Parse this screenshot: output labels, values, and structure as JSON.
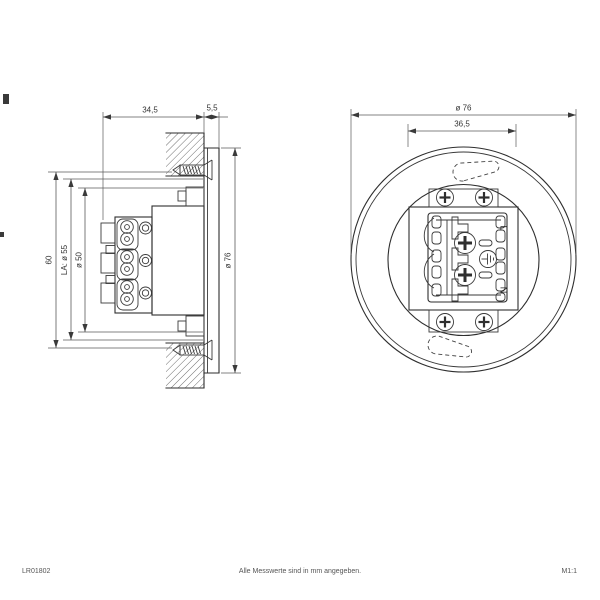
{
  "page": {
    "background": "#ffffff",
    "line_color": "#2e2e2e",
    "dim_color": "#5a5a5a"
  },
  "side_view": {
    "dim_depth": "34,5",
    "dim_flange": "5,5",
    "dim_height": "60",
    "dim_hole_circle": "LA: ø 55",
    "dim_cutout": "ø 50",
    "dim_outer": "ø 76"
  },
  "front_view": {
    "dim_outer": "ø 76",
    "dim_plate": "36,5",
    "terminal_live": "L",
    "terminal_neutral": "N"
  },
  "footer": {
    "doc_number": "LR01802",
    "note": "Alle Messwerte sind in mm angegeben.",
    "scale": "M1:1"
  }
}
